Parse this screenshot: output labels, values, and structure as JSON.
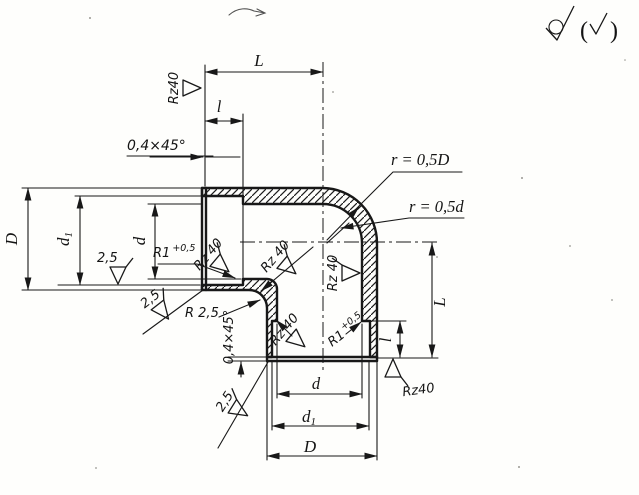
{
  "drawing": {
    "dims": {
      "L": "L",
      "l": "l",
      "D": "D",
      "d": "d",
      "d1_base": "d",
      "d1_sub": "1",
      "chamfer": "0,4×45°",
      "r_outer": "r = 0,5D",
      "r_inner": "r = 0,5d",
      "r_crotch": "R 2,5",
      "r1_base": "R1",
      "r1_sup": "+0,5"
    },
    "finish": {
      "rz40": "Rz40",
      "rz40_sp": "Rz 40",
      "ra25": "2,5",
      "paren_open": "(",
      "paren_close": ")"
    }
  }
}
